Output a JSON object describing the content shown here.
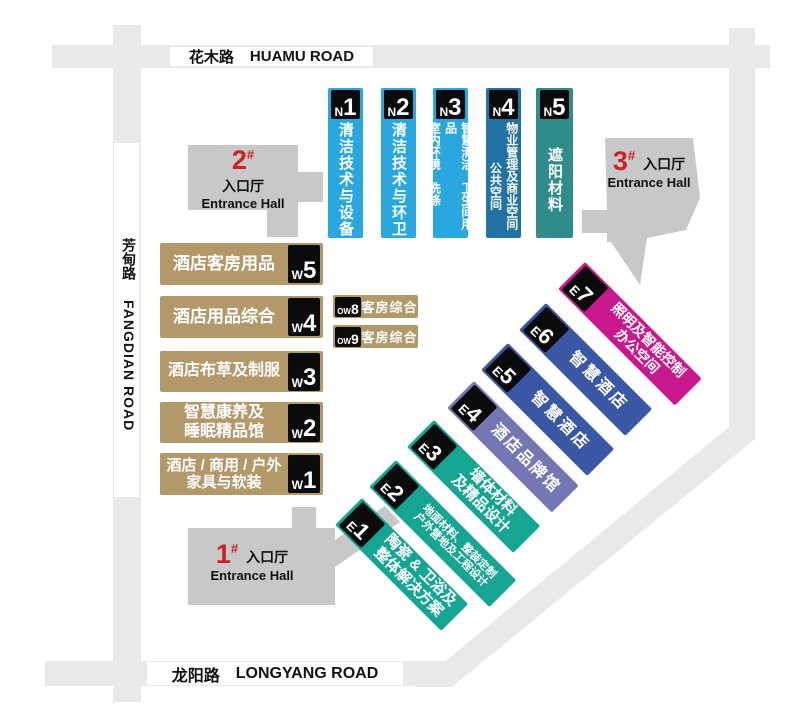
{
  "roads": {
    "top": {
      "zh": "花木路",
      "en": "HUAMU ROAD"
    },
    "left": {
      "zh": "芳甸路",
      "en": "FANGDIAN ROAD"
    },
    "bottom": {
      "zh": "龙阳路",
      "en": "LONGYANG ROAD"
    }
  },
  "entrances": {
    "e1": {
      "num": "1",
      "hash": "#",
      "zh": "入口厅",
      "en": "Entrance Hall"
    },
    "e2": {
      "num": "2",
      "hash": "#",
      "zh": "入口厅",
      "en": "Entrance Hall"
    },
    "e3": {
      "num": "3",
      "hash": "#",
      "zh": "入口厅",
      "en": "Entrance Hall"
    }
  },
  "halls": {
    "n": [
      {
        "code": {
          "letter": "N",
          "digit": "1"
        },
        "label": "清洁技术与设备"
      },
      {
        "code": {
          "letter": "N",
          "digit": "2"
        },
        "label": "清洁技术与环卫"
      },
      {
        "code": {
          "letter": "N",
          "digit": "3"
        },
        "cols": [
          "智慧清洁　卫生间用品",
          "室内环境　洗涤"
        ]
      },
      {
        "code": {
          "letter": "N",
          "digit": "4"
        },
        "cols": [
          "物业管理及商业空间",
          "公共空间"
        ]
      },
      {
        "code": {
          "letter": "N",
          "digit": "5"
        },
        "label": "遮阳材料"
      }
    ],
    "w": [
      {
        "code": {
          "letter": "W",
          "digit": "5"
        },
        "lines": [
          "酒店客房用品"
        ]
      },
      {
        "code": {
          "letter": "W",
          "digit": "4"
        },
        "lines": [
          "酒店用品综合"
        ]
      },
      {
        "code": {
          "letter": "W",
          "digit": "3"
        },
        "lines": [
          "酒店布草及制服"
        ]
      },
      {
        "code": {
          "letter": "W",
          "digit": "2"
        },
        "lines": [
          "智慧康养及",
          "睡眠精品馆"
        ]
      },
      {
        "code": {
          "letter": "W",
          "digit": "1"
        },
        "lines": [
          "酒店 / 商用 / 户外",
          "家具与软装"
        ]
      }
    ],
    "ow": [
      {
        "code": {
          "letter": "OW",
          "digit": "8"
        },
        "label": "客房综合"
      },
      {
        "code": {
          "letter": "OW",
          "digit": "9"
        },
        "label": "客房综合"
      }
    ],
    "e": [
      {
        "code": {
          "letter": "E",
          "digit": "1"
        },
        "lines": [
          "陶瓷 & 卫浴及",
          "整体解决方案"
        ]
      },
      {
        "code": {
          "letter": "E",
          "digit": "2"
        },
        "lines": [
          "地面材料、整装定制",
          "户外营地及工程设计"
        ]
      },
      {
        "code": {
          "letter": "E",
          "digit": "3"
        },
        "lines": [
          "墙体材料",
          "及精品设计"
        ]
      },
      {
        "code": {
          "letter": "E",
          "digit": "4"
        },
        "lines": [
          "酒店品牌馆"
        ]
      },
      {
        "code": {
          "letter": "E",
          "digit": "5"
        },
        "lines": [
          "智慧酒店"
        ]
      },
      {
        "code": {
          "letter": "E",
          "digit": "6"
        },
        "lines": [
          "智慧酒店"
        ]
      },
      {
        "code": {
          "letter": "E",
          "digit": "7"
        },
        "lines": [
          "照明及智能控制",
          "办公空间"
        ]
      }
    ]
  },
  "colors": {
    "road": "#e9e9ea",
    "entrance": "#c8c8ca",
    "n_blue": "#2aa7de",
    "n4_blue": "#2273a5",
    "n5_teal": "#2f8c8a",
    "w_tan": "#b3986a",
    "e_teal": "#16a593",
    "e4_purple": "#7577b5",
    "e56_blue": "#3a57a6",
    "e7_magenta": "#c9188d",
    "badge": "#0b0b0b",
    "red": "#ce2121"
  }
}
